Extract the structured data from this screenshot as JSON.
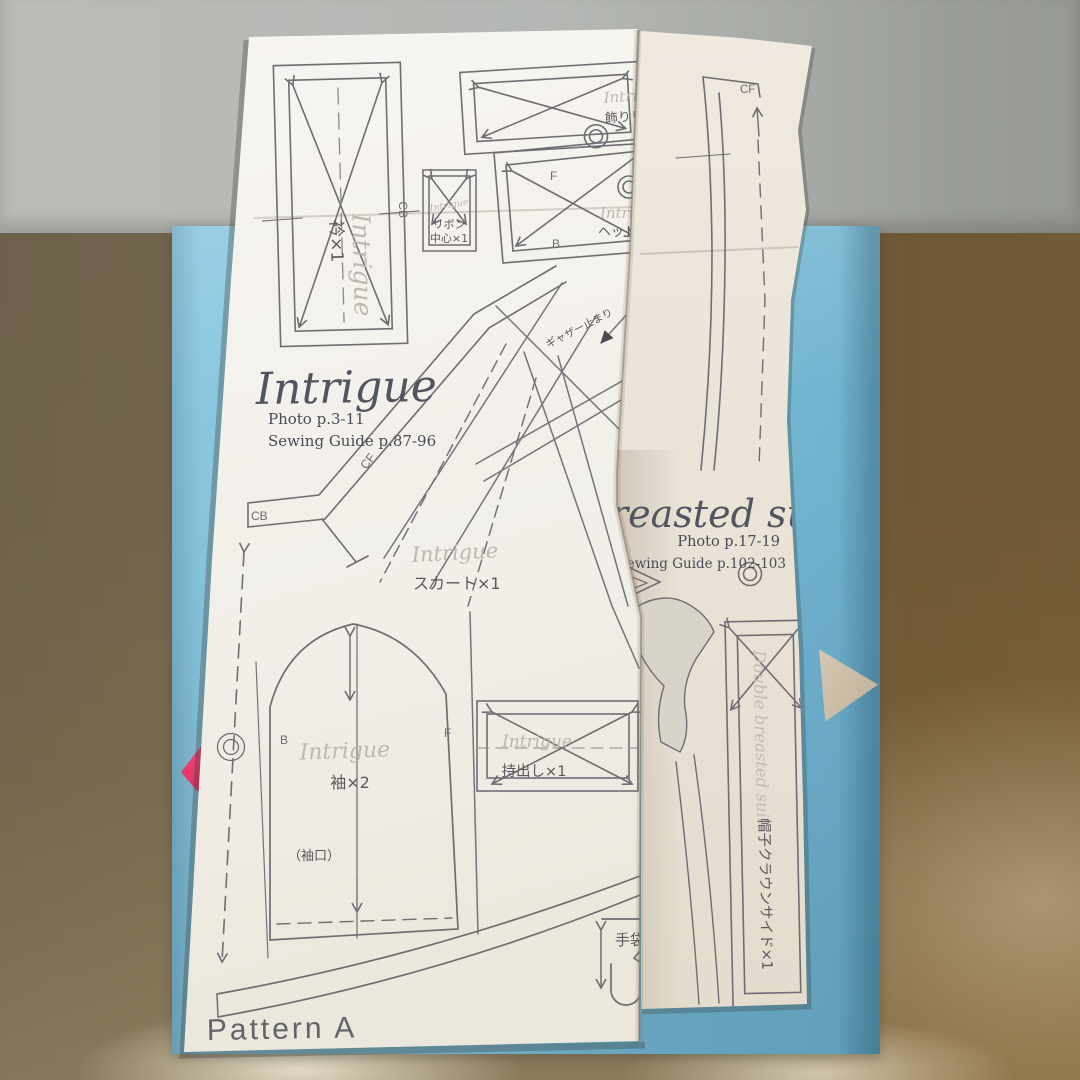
{
  "sheet_left": {
    "title": "Intrigue",
    "photo_ref": "Photo p.3-11",
    "sewing_ref": "Sewing Guide p.87-96",
    "footer": "Pattern A",
    "pieces": {
      "collar": {
        "brand": "Intrigue",
        "label": "衿×1",
        "cb": "CB"
      },
      "ribbon_center": {
        "brand": "Intrigue",
        "line1": "リボン",
        "line2": "中心×1"
      },
      "decorative_ribbon": {
        "brand": "Intrigue",
        "label": "飾りリ"
      },
      "headdress": {
        "brand": "Intrigue",
        "label": "ヘッド",
        "front": "F",
        "back": "B"
      },
      "waistband": {
        "cf": "CF",
        "cb": "CB"
      },
      "skirt": {
        "brand": "Intrigue",
        "label": "スカート×1",
        "annotation": "ギャザー止まり"
      },
      "sleeve": {
        "brand": "Intrigue",
        "label": "袖×2",
        "front": "F",
        "back": "B",
        "cuff": "（袖口）"
      },
      "extension": {
        "brand": "Intrigue",
        "label": "持出し×1"
      },
      "glove": {
        "label": "手袋"
      }
    }
  },
  "sheet_right": {
    "title": "reasted suit",
    "photo_ref": "Photo p.17-19",
    "sewing_ref": "Sewing Guide p.102-103",
    "pieces": {
      "front": {
        "cf": "CF"
      },
      "hat_crown_side": {
        "brand": "Double breasted suit",
        "label": "帽子クラウンサイド×1"
      }
    }
  },
  "colors": {
    "folder_blue": "#7fc0da",
    "paper": "#f3f1ec",
    "pattern_line": "#6f6d72",
    "brand_gray": "#bdb8b0",
    "label_ink": "#5a585c",
    "title_ink": "#50555f",
    "pink_tab": "#ee3a72",
    "leather_tan": "#b3a78e",
    "couch_gray": "#adb0ac"
  }
}
